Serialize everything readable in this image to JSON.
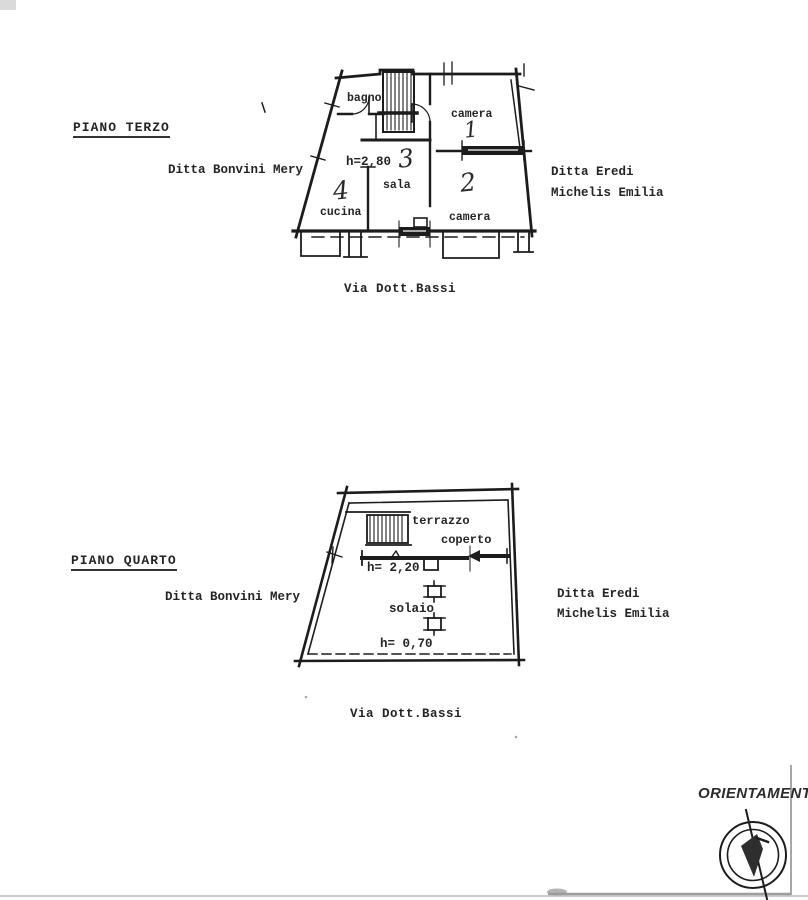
{
  "floors": [
    {
      "heading": "PIANO TERZO",
      "owner_left": "Ditta Bonvini Mery",
      "owner_right_line1": "Ditta Eredi",
      "owner_right_line2": "Michelis Emilia",
      "street": "Via Dott.Bassi",
      "height_note": "h=2,80",
      "rooms": {
        "bagno": "bagno",
        "camera1": "camera",
        "camera1_number": "1",
        "camera2": "camera",
        "camera2_number": "2",
        "sala": "sala",
        "sala_number": "3",
        "cucina": "cucina",
        "cucina_number": "4"
      }
    },
    {
      "heading": "PIANO QUARTO",
      "owner_left": "Ditta Bonvini Mery",
      "owner_right_line1": "Ditta Eredi",
      "owner_right_line2": "Michelis Emilia",
      "street": "Via Dott.Bassi",
      "height_note_upper": "h= 2,20",
      "height_note_lower": "h= 0,70",
      "rooms": {
        "terrazzo": "terrazzo",
        "coperto": "coperto",
        "solaio": "solaio"
      }
    }
  ],
  "compass": {
    "label": "ORIENTAMENTO"
  },
  "ink_color": "#1c1c1c"
}
